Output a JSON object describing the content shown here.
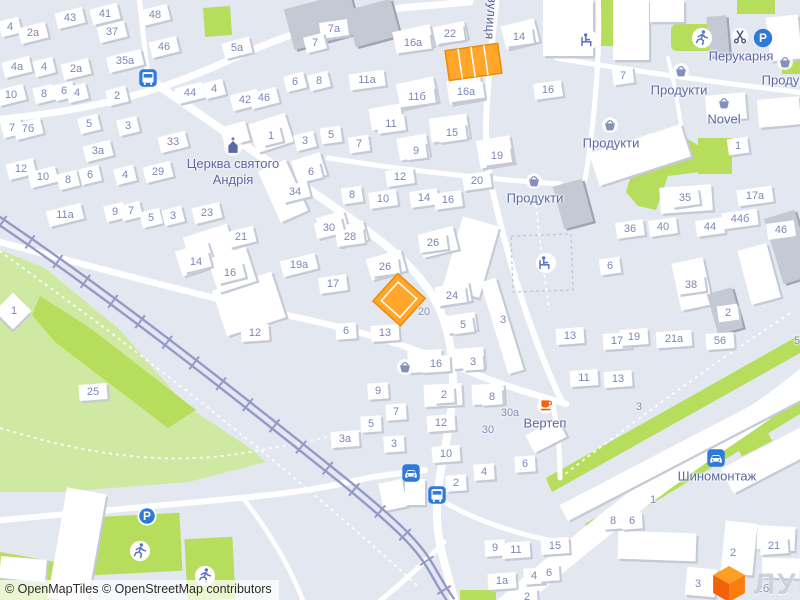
{
  "attribution": "© OpenMapTiles © OpenStreetMap contributors",
  "logo": {
    "text": "ЛУН"
  },
  "street_label": {
    "text": "вулиця",
    "x": 491,
    "y": 18,
    "angle": 94
  },
  "church": {
    "line1": "Церква святого",
    "line2": "Андрія",
    "x": 233,
    "y": 172,
    "icon_x": 233,
    "icon_y": 146
  },
  "labels": [
    {
      "text": "Продукти",
      "x": 679,
      "y": 90
    },
    {
      "text": "Продукти",
      "x": 790,
      "y": 80
    },
    {
      "text": "Продукти",
      "x": 611,
      "y": 143
    },
    {
      "text": "Продукти",
      "x": 535,
      "y": 198
    },
    {
      "text": "Novel",
      "x": 724,
      "y": 119
    },
    {
      "text": "Перукарня",
      "x": 741,
      "y": 56
    },
    {
      "text": "Вертеп",
      "x": 545,
      "y": 423
    },
    {
      "text": "Шиномонтаж",
      "x": 717,
      "y": 476
    }
  ],
  "icons": [
    {
      "name": "basket",
      "x": 681,
      "y": 71
    },
    {
      "name": "basket",
      "x": 785,
      "y": 62
    },
    {
      "name": "basket",
      "x": 610,
      "y": 125
    },
    {
      "name": "basket",
      "x": 534,
      "y": 181
    },
    {
      "name": "basket",
      "x": 724,
      "y": 103
    },
    {
      "name": "basket",
      "x": 405,
      "y": 367
    },
    {
      "name": "scissors",
      "x": 740,
      "y": 37
    },
    {
      "name": "parking",
      "x": 763,
      "y": 38
    },
    {
      "name": "parking-ring",
      "x": 147,
      "y": 516
    },
    {
      "name": "cup",
      "x": 546,
      "y": 405
    },
    {
      "name": "car",
      "x": 716,
      "y": 458
    },
    {
      "name": "car",
      "x": 411,
      "y": 473
    },
    {
      "name": "bus",
      "x": 148,
      "y": 78
    },
    {
      "name": "bus",
      "x": 437,
      "y": 495
    },
    {
      "name": "runner",
      "x": 702,
      "y": 38
    },
    {
      "name": "runner",
      "x": 140,
      "y": 551
    },
    {
      "name": "runner",
      "x": 205,
      "y": 576
    },
    {
      "name": "seated",
      "x": 588,
      "y": 40
    },
    {
      "name": "seated",
      "x": 546,
      "y": 263
    },
    {
      "name": "church",
      "x": 233,
      "y": 146
    }
  ],
  "house_numbers": [
    {
      "t": "4",
      "x": 10,
      "y": 27
    },
    {
      "t": "2a",
      "x": 33,
      "y": 33
    },
    {
      "t": "43",
      "x": 70,
      "y": 18
    },
    {
      "t": "41",
      "x": 105,
      "y": 14
    },
    {
      "t": "37",
      "x": 112,
      "y": 32
    },
    {
      "t": "48",
      "x": 155,
      "y": 15
    },
    {
      "t": "46",
      "x": 164,
      "y": 47
    },
    {
      "t": "5a",
      "x": 237,
      "y": 48
    },
    {
      "t": "35a",
      "x": 125,
      "y": 61
    },
    {
      "t": "4a",
      "x": 17,
      "y": 67
    },
    {
      "t": "4",
      "x": 44,
      "y": 67
    },
    {
      "t": "2a",
      "x": 76,
      "y": 69
    },
    {
      "t": "10",
      "x": 11,
      "y": 95
    },
    {
      "t": "8",
      "x": 44,
      "y": 94
    },
    {
      "t": "6",
      "x": 64,
      "y": 91
    },
    {
      "t": "4",
      "x": 77,
      "y": 93
    },
    {
      "t": "2",
      "x": 117,
      "y": 96
    },
    {
      "t": "44",
      "x": 190,
      "y": 93
    },
    {
      "t": "4",
      "x": 214,
      "y": 89
    },
    {
      "t": "42",
      "x": 245,
      "y": 100
    },
    {
      "t": "46",
      "x": 264,
      "y": 98
    },
    {
      "t": "7",
      "x": 12,
      "y": 128
    },
    {
      "t": "7б",
      "x": 28,
      "y": 129
    },
    {
      "t": "5",
      "x": 89,
      "y": 124
    },
    {
      "t": "3",
      "x": 128,
      "y": 126
    },
    {
      "t": "33",
      "x": 173,
      "y": 142
    },
    {
      "t": "3a",
      "x": 98,
      "y": 151
    },
    {
      "t": "12",
      "x": 21,
      "y": 169
    },
    {
      "t": "10",
      "x": 43,
      "y": 177
    },
    {
      "t": "8",
      "x": 68,
      "y": 180
    },
    {
      "t": "6",
      "x": 90,
      "y": 175
    },
    {
      "t": "4",
      "x": 125,
      "y": 175
    },
    {
      "t": "29",
      "x": 158,
      "y": 172
    },
    {
      "t": "11a",
      "x": 65,
      "y": 215
    },
    {
      "t": "9",
      "x": 115,
      "y": 212
    },
    {
      "t": "7",
      "x": 131,
      "y": 211
    },
    {
      "t": "5",
      "x": 151,
      "y": 218
    },
    {
      "t": "3",
      "x": 173,
      "y": 216
    },
    {
      "t": "23",
      "x": 207,
      "y": 213
    },
    {
      "t": "21",
      "x": 241,
      "y": 237
    },
    {
      "t": "14",
      "x": 196,
      "y": 262
    },
    {
      "t": "16",
      "x": 230,
      "y": 273
    },
    {
      "t": "1",
      "x": 14,
      "y": 311,
      "b": 0
    },
    {
      "t": "12",
      "x": 255,
      "y": 333
    },
    {
      "t": "25",
      "x": 93,
      "y": 392
    },
    {
      "t": "7a",
      "x": 334,
      "y": 29
    },
    {
      "t": "7",
      "x": 315,
      "y": 43
    },
    {
      "t": "16a",
      "x": 413,
      "y": 43
    },
    {
      "t": "22",
      "x": 450,
      "y": 34
    },
    {
      "t": "14",
      "x": 519,
      "y": 37
    },
    {
      "t": "6",
      "x": 295,
      "y": 82
    },
    {
      "t": "8",
      "x": 319,
      "y": 81
    },
    {
      "t": "11a",
      "x": 367,
      "y": 80
    },
    {
      "t": "11б",
      "x": 417,
      "y": 97
    },
    {
      "t": "16a",
      "x": 466,
      "y": 92
    },
    {
      "t": "11",
      "x": 391,
      "y": 124
    },
    {
      "t": "15",
      "x": 452,
      "y": 133
    },
    {
      "t": "16",
      "x": 548,
      "y": 90
    },
    {
      "t": "7",
      "x": 623,
      "y": 76
    },
    {
      "t": "1",
      "x": 271,
      "y": 136
    },
    {
      "t": "3",
      "x": 305,
      "y": 141
    },
    {
      "t": "5",
      "x": 331,
      "y": 135
    },
    {
      "t": "7",
      "x": 359,
      "y": 144
    },
    {
      "t": "9",
      "x": 416,
      "y": 151
    },
    {
      "t": "19",
      "x": 497,
      "y": 156
    },
    {
      "t": "6",
      "x": 311,
      "y": 172
    },
    {
      "t": "34",
      "x": 295,
      "y": 192
    },
    {
      "t": "8",
      "x": 352,
      "y": 195
    },
    {
      "t": "10",
      "x": 383,
      "y": 199
    },
    {
      "t": "12",
      "x": 400,
      "y": 177
    },
    {
      "t": "14",
      "x": 424,
      "y": 198
    },
    {
      "t": "16",
      "x": 448,
      "y": 200
    },
    {
      "t": "20",
      "x": 477,
      "y": 181
    },
    {
      "t": "30",
      "x": 329,
      "y": 228
    },
    {
      "t": "28",
      "x": 350,
      "y": 237
    },
    {
      "t": "26",
      "x": 433,
      "y": 243
    },
    {
      "t": "26",
      "x": 385,
      "y": 267
    },
    {
      "t": "19a",
      "x": 299,
      "y": 265
    },
    {
      "t": "17",
      "x": 333,
      "y": 284
    },
    {
      "t": "35",
      "x": 685,
      "y": 198
    },
    {
      "t": "1",
      "x": 738,
      "y": 146
    },
    {
      "t": "17a",
      "x": 755,
      "y": 196
    },
    {
      "t": "36",
      "x": 630,
      "y": 229
    },
    {
      "t": "40",
      "x": 663,
      "y": 227
    },
    {
      "t": "44",
      "x": 710,
      "y": 227
    },
    {
      "t": "44б",
      "x": 740,
      "y": 219
    },
    {
      "t": "46",
      "x": 781,
      "y": 230
    },
    {
      "t": "6",
      "x": 610,
      "y": 266
    },
    {
      "t": "38",
      "x": 691,
      "y": 285
    },
    {
      "t": "2",
      "x": 728,
      "y": 313
    },
    {
      "t": "13",
      "x": 570,
      "y": 336
    },
    {
      "t": "17",
      "x": 617,
      "y": 341
    },
    {
      "t": "19",
      "x": 634,
      "y": 337
    },
    {
      "t": "21a",
      "x": 674,
      "y": 339
    },
    {
      "t": "56",
      "x": 720,
      "y": 341
    },
    {
      "t": "5",
      "x": 797,
      "y": 341,
      "b": 0
    },
    {
      "t": "11",
      "x": 584,
      "y": 378
    },
    {
      "t": "13",
      "x": 618,
      "y": 379
    },
    {
      "t": "3",
      "x": 639,
      "y": 407,
      "b": 0
    },
    {
      "t": "3",
      "x": 503,
      "y": 320,
      "b": 0
    },
    {
      "t": "24",
      "x": 452,
      "y": 296
    },
    {
      "t": "20",
      "x": 424,
      "y": 312,
      "b": 0
    },
    {
      "t": "5",
      "x": 463,
      "y": 325
    },
    {
      "t": "13",
      "x": 385,
      "y": 333
    },
    {
      "t": "6",
      "x": 346,
      "y": 331
    },
    {
      "t": "16",
      "x": 436,
      "y": 364
    },
    {
      "t": "3",
      "x": 473,
      "y": 362
    },
    {
      "t": "9",
      "x": 378,
      "y": 391
    },
    {
      "t": "2",
      "x": 444,
      "y": 395
    },
    {
      "t": "8",
      "x": 492,
      "y": 397
    },
    {
      "t": "7",
      "x": 396,
      "y": 412
    },
    {
      "t": "30a",
      "x": 510,
      "y": 413,
      "b": 0
    },
    {
      "t": "5",
      "x": 371,
      "y": 424
    },
    {
      "t": "12",
      "x": 441,
      "y": 423
    },
    {
      "t": "3a",
      "x": 345,
      "y": 439
    },
    {
      "t": "3",
      "x": 394,
      "y": 444
    },
    {
      "t": "30",
      "x": 488,
      "y": 430,
      "b": 0
    },
    {
      "t": "10",
      "x": 446,
      "y": 454
    },
    {
      "t": "4",
      "x": 484,
      "y": 472
    },
    {
      "t": "2",
      "x": 456,
      "y": 483
    },
    {
      "t": "6",
      "x": 525,
      "y": 464
    },
    {
      "t": "9",
      "x": 495,
      "y": 548
    },
    {
      "t": "11",
      "x": 516,
      "y": 550
    },
    {
      "t": "15",
      "x": 555,
      "y": 546
    },
    {
      "t": "1a",
      "x": 502,
      "y": 581
    },
    {
      "t": "4",
      "x": 534,
      "y": 576
    },
    {
      "t": "6",
      "x": 549,
      "y": 573
    },
    {
      "t": "2",
      "x": 527,
      "y": 597
    },
    {
      "t": "8",
      "x": 613,
      "y": 521
    },
    {
      "t": "6",
      "x": 632,
      "y": 521
    },
    {
      "t": "1",
      "x": 653,
      "y": 500,
      "b": 0
    },
    {
      "t": "2",
      "x": 733,
      "y": 553,
      "b": 0
    },
    {
      "t": "21",
      "x": 774,
      "y": 546
    },
    {
      "t": "3",
      "x": 698,
      "y": 584,
      "b": 0
    },
    {
      "t": "2б",
      "x": 763,
      "y": 589,
      "b": 0
    }
  ],
  "colors": {
    "background": "#e3e7f0",
    "road": "#ffffff",
    "park": "#cfe9a2",
    "green": "#b6dd5b",
    "rail": "#9599c8",
    "number": "#7e86b6",
    "label": "#5c69a4",
    "highlight": "#ffa62b",
    "highlight_border": "#ee8a00",
    "poi_blue": "#2e7ad8",
    "brand_orange": "#f2620a",
    "building": "#ffffff",
    "building_gray": "#c5c9d4",
    "shadow": "#c6cad6"
  }
}
